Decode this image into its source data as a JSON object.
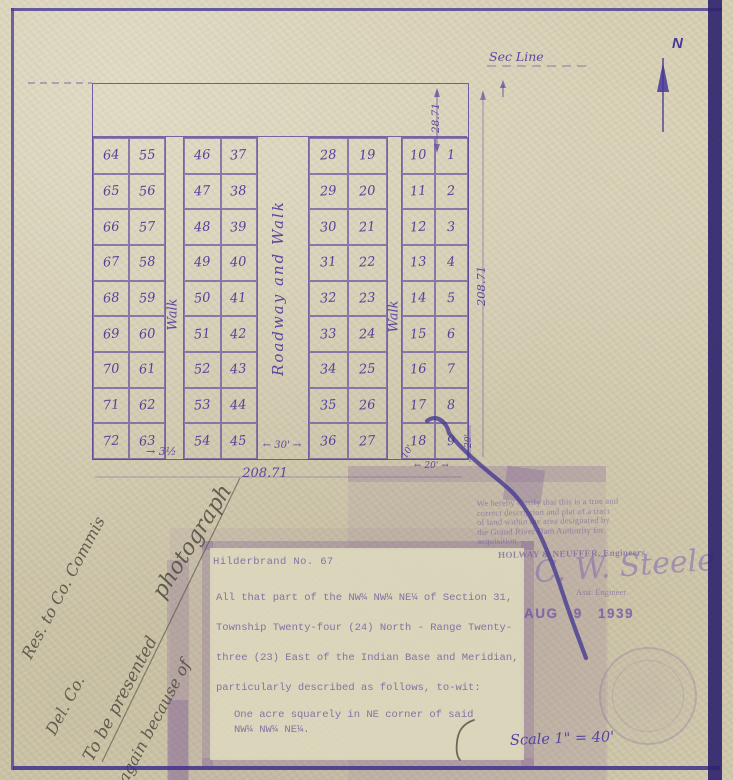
{
  "plat": {
    "north_label": "N",
    "sec_line_label": "Sec Line",
    "walk_left_label": "Walk",
    "roadway_label": "Roadway and Walk",
    "walk_right_label": "Walk",
    "dims": {
      "strip_height": "28.71",
      "side_height": "208.71",
      "bottom_width": "208.71",
      "walk_left": "→ 3½",
      "roadway": "← 30' →",
      "walk_right": "10'",
      "lot_w": "← 20' →",
      "lot_h": "20'"
    },
    "blocks": [
      {
        "id": "block-a",
        "columns": [
          [
            64,
            65,
            66,
            67,
            68,
            69,
            70,
            71,
            72
          ],
          [
            55,
            56,
            57,
            58,
            59,
            60,
            61,
            62,
            63
          ]
        ]
      },
      {
        "id": "block-b",
        "columns": [
          [
            46,
            47,
            48,
            49,
            50,
            51,
            52,
            53,
            54
          ],
          [
            37,
            38,
            39,
            40,
            41,
            42,
            43,
            44,
            45
          ]
        ]
      },
      {
        "id": "block-c",
        "columns": [
          [
            28,
            29,
            30,
            31,
            32,
            33,
            34,
            35,
            36
          ],
          [
            19,
            20,
            21,
            22,
            23,
            24,
            25,
            26,
            27
          ]
        ]
      },
      {
        "id": "block-d",
        "columns": [
          [
            10,
            11,
            12,
            13,
            14,
            15,
            16,
            17,
            18
          ],
          [
            1,
            2,
            3,
            4,
            5,
            6,
            7,
            8,
            9
          ]
        ]
      }
    ]
  },
  "certification": {
    "lines": [
      "We hereby certify that this is a true and",
      "correct description and plat of a tract",
      "of land within the area designated by",
      "the Grand River Dam Authority for",
      "acquisition."
    ],
    "engineers": "HOLWAY & NEUFFER, Engineers",
    "signature": "C. W. Steele",
    "signature_title": "Asst. Engineer"
  },
  "date_stamp": "AUG 9 1939",
  "description": {
    "heading": "Hilderbrand No. 67",
    "lines": [
      "All that part of the NW¼ NW¼ NE¼ of Section 31,",
      "Township Twenty-four (24) North - Range Twenty-",
      "three (23) East of the Indian Base and Meridian,",
      "particularly described as follows, to-wit:"
    ],
    "indent_lines": [
      "One acre squarely in NE corner of said",
      "NW¼ NW¼ NE¼."
    ]
  },
  "annotations": {
    "note_lines": [
      "Res. to Co. Commis",
      "Del. Co.",
      "To be presented",
      "again because of",
      "photograph"
    ],
    "scale": "Scale 1\" = 40'"
  }
}
